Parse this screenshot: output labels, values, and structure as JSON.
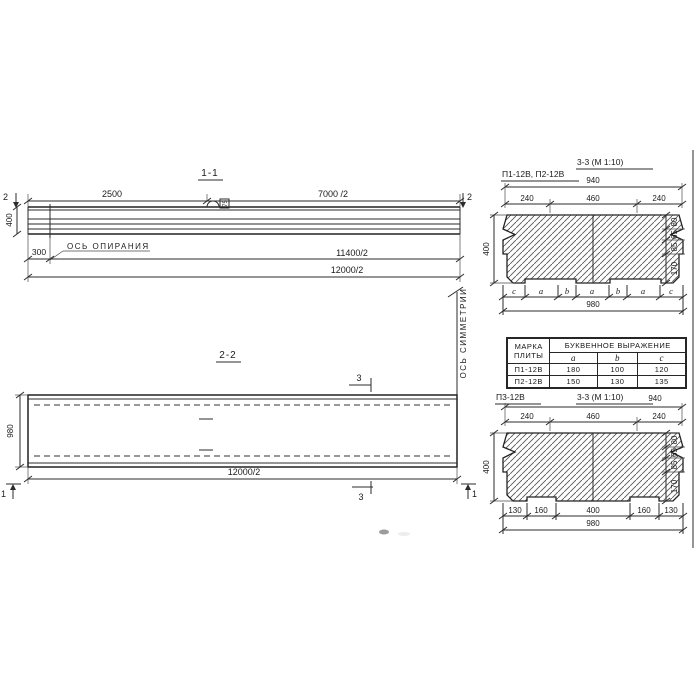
{
  "page": {
    "background": "#ffffff",
    "ink": "#2b2b2b"
  },
  "sections": {
    "s11": {
      "title": "1-1",
      "cut_mark": "2",
      "dim_top_left": "2500",
      "dim_top_right": "7000 /2",
      "dim_height": "400",
      "dim_offset": "300",
      "support_axis_label": "ОСЬ ОПИРАНИЯ",
      "dim_mid": "11400/2",
      "dim_total": "12000/2",
      "loop_label": "75"
    },
    "symmetry_axis_label": "ОСЬ СИММЕТРИИ",
    "s22": {
      "title": "2-2",
      "cut_mark_3": "3",
      "cut_mark_1": "1",
      "dim_height": "980",
      "dim_total": "12000/2"
    },
    "s33a": {
      "label": "П1-12В, П2-12В",
      "title": "3-3 (М 1:10)",
      "dim_top_total": "940",
      "dims_top": [
        "240",
        "460",
        "240"
      ],
      "dim_height": "400",
      "dims_right": [
        "80",
        "65",
        "85",
        "170"
      ],
      "letters": [
        "c",
        "a",
        "b",
        "a",
        "b",
        "a",
        "c"
      ],
      "dim_bottom_total": "980"
    },
    "s33b": {
      "label": "П3-12В",
      "title": "3-3 (М 1:10)",
      "dim_top_total": "940",
      "dims_top": [
        "240",
        "460",
        "240"
      ],
      "dim_height": "400",
      "dims_right": [
        "80",
        "65",
        "85",
        "170"
      ],
      "dims_bottom": [
        "130",
        "160",
        "400",
        "160",
        "130"
      ],
      "dim_bottom_total": "980"
    }
  },
  "table": {
    "col_mark": "МАРКА\nПЛИТЫ",
    "col_expr": "БУКВЕННОЕ ВЫРАЖЕНИЕ",
    "cols": [
      "a",
      "b",
      "c"
    ],
    "rows": [
      {
        "mark": "П1-12В",
        "a": "180",
        "b": "100",
        "c": "120"
      },
      {
        "mark": "П2-12В",
        "a": "150",
        "b": "130",
        "c": "135"
      }
    ]
  }
}
